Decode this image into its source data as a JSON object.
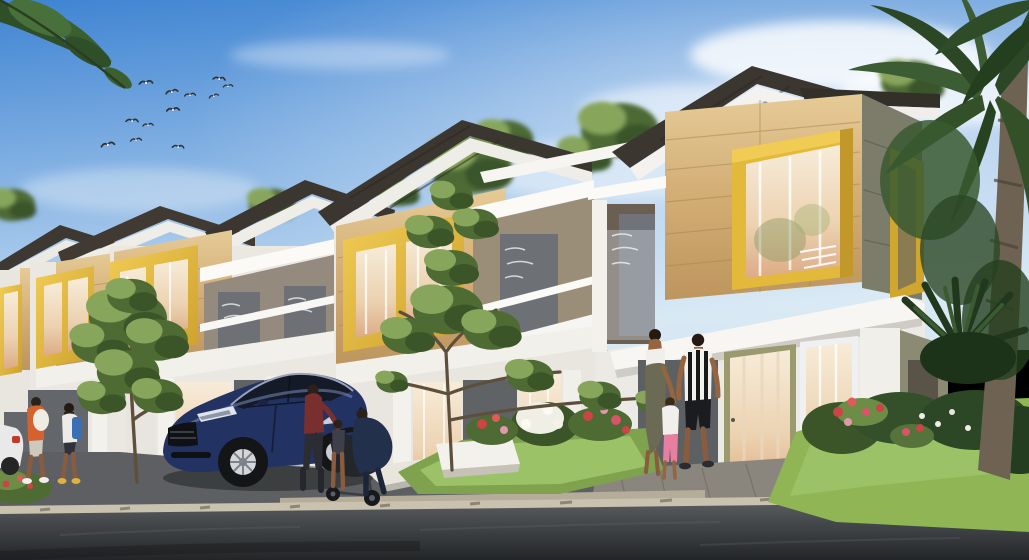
{
  "scene": {
    "type": "architectural-rendering",
    "description": "Daytime exterior rendering of a row of modern two-storey townhouses with wood-panel facades and yellow box window frames. A dark blue sedan is parked in a driveway, a family of three walks toward the nearest house, two pedestrians walk on the left, a stroller stands behind the car, birds fly in a blue sky and a tall palm tree frames the right edge.",
    "time_of_day": "day",
    "weather": "clear blue sky with soft clouds"
  },
  "palette": {
    "sky_top": "#3f84d2",
    "sky_horizon": "#d7e8f4",
    "roof_dark": "#3b362f",
    "wall_white": "#f1efea",
    "wood_light": "#dfc291",
    "wood_dark": "#b8925c",
    "accent_yellow": "#e2b93b",
    "accent_yellow_dark": "#c3982a",
    "panel_gray": "#64686c",
    "olive_panel": "#7c7c6a",
    "glass_warm": "#f0d9bc",
    "curtain_peach": "#dcab85",
    "road_dark": "#37393c",
    "curb_tan": "#c9c2af",
    "driveway_gray": "#515356",
    "grass_green": "#8fb554",
    "foliage_dark": "#2e4f28",
    "foliage_mid": "#4e6b34",
    "foliage_light": "#87a65c",
    "flower_red": "#cc4444",
    "flower_pink": "#e099aa",
    "flower_white": "#f0efe6",
    "car_navy": "#223263",
    "car_window": "#141a28",
    "palm_green": "#3c5c33",
    "palm_trunk": "#6e6352",
    "skin_tone": "#96653f",
    "shirt_orange": "#d4622f",
    "shirt_maroon": "#7a2f2f",
    "pants_pink": "#e87fa0",
    "backpack_blue": "#3a6fb5"
  },
  "objects": {
    "houses": {
      "count": 5,
      "style": "modern townhouse row, two storeys, dark hip roofs, wood cladding, yellow window boxes, white balconies with fritted glass railings, warm-lit glass doors on ground floor"
    },
    "vehicles": [
      {
        "name": "blue-sedan",
        "color_key": "car_navy",
        "position": "parked in driveway, facing left"
      },
      {
        "name": "white-car-partial",
        "position": "far left edge, mostly cropped"
      }
    ],
    "people": [
      {
        "name": "pedestrian-orange-shirt",
        "detail": "carrying white bundle, left sidewalk"
      },
      {
        "name": "pedestrian-girl-backpack",
        "detail": "blue backpack, left sidewalk"
      },
      {
        "name": "adult-maroon-top",
        "detail": "standing at open car door"
      },
      {
        "name": "child-at-car",
        "detail": "small child beside stroller"
      },
      {
        "name": "person-crouching-dark",
        "detail": "leaning over stroller"
      },
      {
        "name": "woman-white-top",
        "detail": "olive skirt, walking with child"
      },
      {
        "name": "child-pink-pants",
        "detail": "white shirt, pink pants"
      },
      {
        "name": "man-striped-shirt",
        "detail": "black and white striped shirt, black shorts"
      }
    ],
    "vegetation": [
      {
        "name": "palm-tree-right"
      },
      {
        "name": "sago-palm-bottom-right"
      },
      {
        "name": "street-tree-left"
      },
      {
        "name": "street-tree-center"
      },
      {
        "name": "flower-beds",
        "detail": "red, pink and white flowers over bright lawn"
      },
      {
        "name": "overhanging-leaves-top-left"
      }
    ],
    "birds": {
      "count": 12,
      "detail": "small gliding birds, upper left sky"
    }
  }
}
